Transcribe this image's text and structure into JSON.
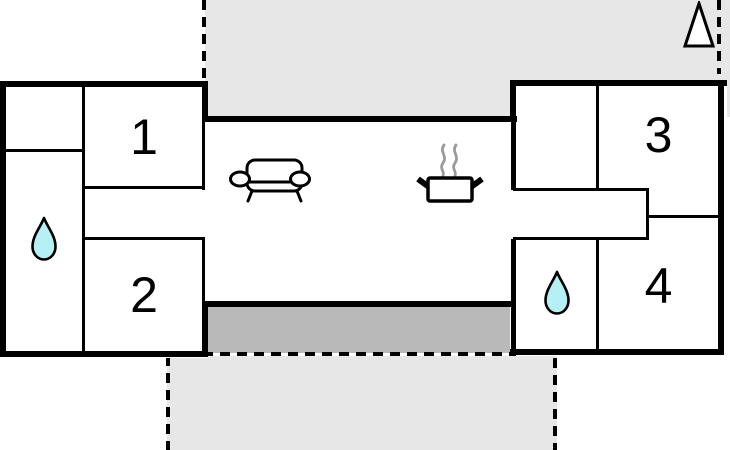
{
  "rooms": [
    {
      "name": "bedroom-1",
      "label": "1"
    },
    {
      "name": "bedroom-2",
      "label": "2"
    },
    {
      "name": "bedroom-3",
      "label": "3"
    },
    {
      "name": "bedroom-4",
      "label": "4"
    }
  ],
  "icons": [
    {
      "name": "water-drop-icon",
      "location": "left-bathroom"
    },
    {
      "name": "water-drop-icon",
      "location": "right-bathroom"
    },
    {
      "name": "sofa-icon",
      "location": "living-area"
    },
    {
      "name": "cooking-pot-icon",
      "location": "kitchen-area"
    },
    {
      "name": "tree-icon",
      "location": "top-right-terrace"
    }
  ],
  "colors": {
    "wall": "#000000",
    "terrace_light": "#e7e7e7",
    "terrace_dark": "#b9b9b9",
    "water_drop": "#b5f0f4",
    "steam": "#9b9b9b",
    "background": "#ffffff"
  }
}
